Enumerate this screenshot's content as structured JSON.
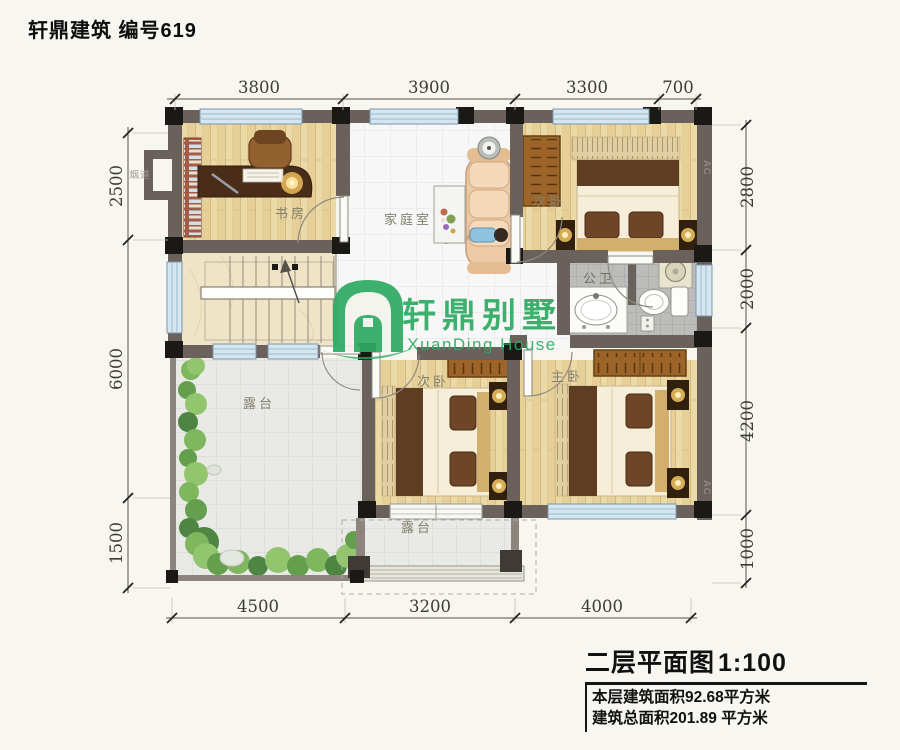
{
  "page": {
    "title": "轩鼎建筑 编号619"
  },
  "logo": {
    "name": "轩鼎别墅",
    "subtitle": "XuanDing House",
    "color": "#2faa63"
  },
  "rooms": [
    {
      "id": "study",
      "label": "书房"
    },
    {
      "id": "family-room",
      "label": "家庭室"
    },
    {
      "id": "bedroom-top",
      "label": "次卧"
    },
    {
      "id": "bathroom",
      "label": "公卫"
    },
    {
      "id": "bedroom-mid",
      "label": "次卧"
    },
    {
      "id": "master-bedroom",
      "label": "主卧"
    },
    {
      "id": "terrace-large",
      "label": "露台"
    },
    {
      "id": "terrace-small",
      "label": "露台"
    }
  ],
  "annotations": {
    "flue": "烟道",
    "ac": "AC"
  },
  "dimensions": {
    "top": [
      "3800",
      "3900",
      "3300",
      "700"
    ],
    "bottom": [
      "4500",
      "3200",
      "4000"
    ],
    "left": [
      "2500",
      "6000",
      "1500"
    ],
    "right": [
      "2800",
      "2000",
      "4200",
      "1000"
    ]
  },
  "title_block": {
    "drawing_title": "二层平面图",
    "scale": "1:100",
    "floor_area": "本层建筑面积92.68平方米",
    "total_area": "建筑总面积201.89 平方米"
  }
}
